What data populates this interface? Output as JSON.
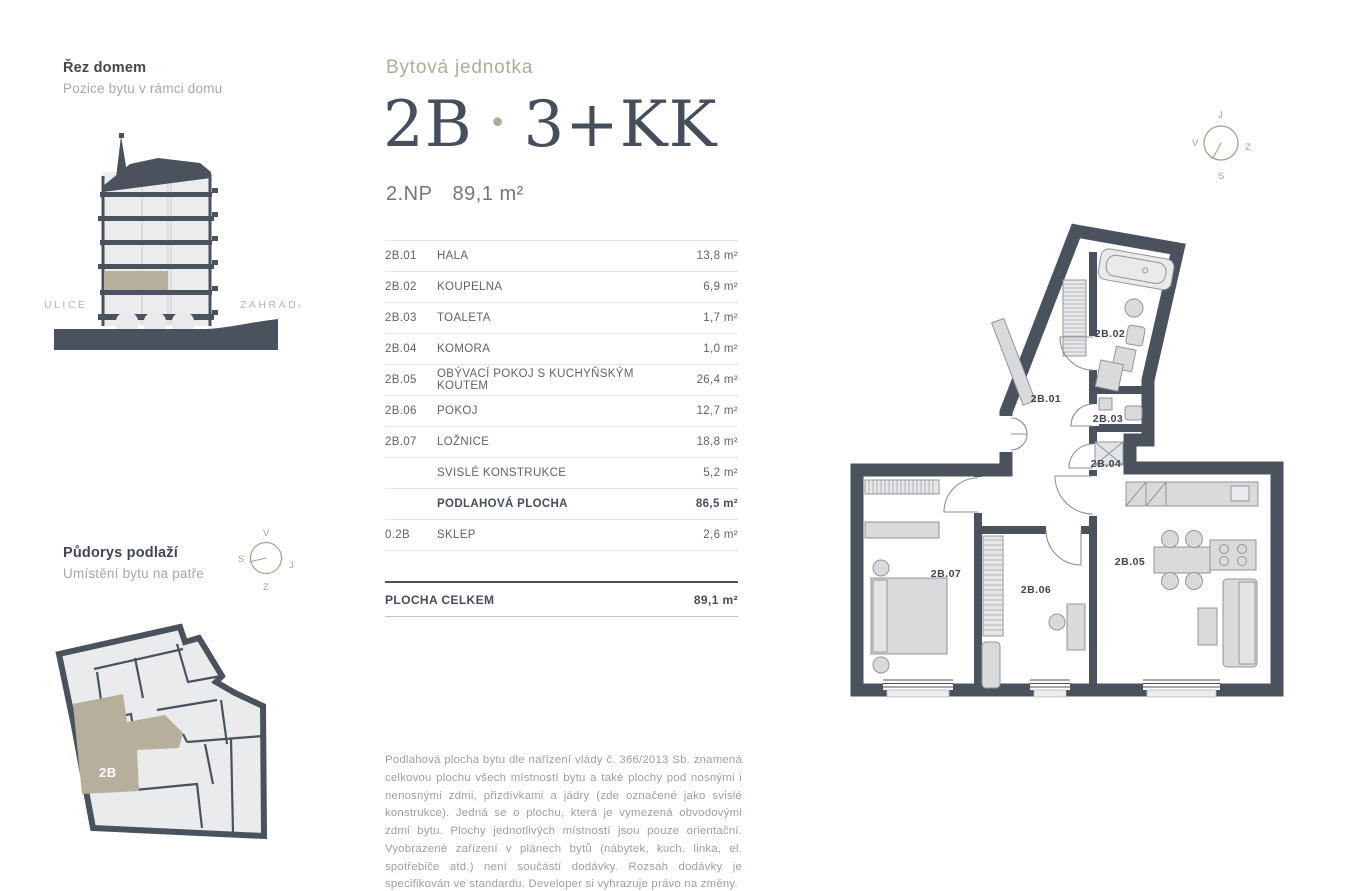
{
  "colors": {
    "wall_dark": "#4a525e",
    "title_dark": "#454e5b",
    "gold": "#b2ab96",
    "beige_highlight": "#b6af9c",
    "room_fill": "#eaebec",
    "furniture_fill": "#d9dadb",
    "muted_text": "#9aa0a7"
  },
  "section_view": {
    "title": "Řez domem",
    "subtitle": "Pozice bytu v rámci domu",
    "label_left": "ULICE",
    "label_right": "ZAHRADA"
  },
  "floor_overview": {
    "title": "Půdorys podlaží",
    "subtitle": "Umístění bytu na patře",
    "unit_label": "2B",
    "compass": {
      "top": "V",
      "left": "S",
      "right": "J",
      "bottom": "Z"
    }
  },
  "header": {
    "eyebrow": "Bytová jednotka",
    "unit": "2B",
    "separator": "•",
    "layout": "3+KK",
    "floor": "2.NP",
    "area": "89,1 m²"
  },
  "table": {
    "rows": [
      {
        "code": "2B.01",
        "name": "HALA",
        "area": "13,8 m²"
      },
      {
        "code": "2B.02",
        "name": "KOUPELNA",
        "area": "6,9 m²"
      },
      {
        "code": "2B.03",
        "name": "TOALETA",
        "area": "1,7 m²"
      },
      {
        "code": "2B.04",
        "name": "KOMORA",
        "area": "1,0 m²"
      },
      {
        "code": "2B.05",
        "name": "OBÝVACÍ POKOJ S KUCHYŇSKÝM KOUTEM",
        "area": "26,4 m²"
      },
      {
        "code": "2B.06",
        "name": "POKOJ",
        "area": "12,7 m²"
      },
      {
        "code": "2B.07",
        "name": "LOŽNICE",
        "area": "18,8 m²"
      },
      {
        "code": "",
        "name": "SVISLÉ KONSTRUKCE",
        "area": "5,2 m²"
      },
      {
        "code": "",
        "name": "PODLAHOVÁ PLOCHA",
        "area": "86,5 m²"
      },
      {
        "code": "0.2B",
        "name": "SKLEP",
        "area": "2,6 m²"
      }
    ],
    "total": {
      "name": "PLOCHA CELKEM",
      "area": "89,1 m²"
    }
  },
  "disclaimer": "Podlahová plocha bytu dle nařízení vlády č. 366/2013 Sb. znamená celkovou plochu všech místností bytu a také plochy pod nosnými i nenosnými zdmi, přizdívkami a jádry (zde označené jako svislé konstrukce). Jedná se o plochu, která je vymezená obvodovými zdmi bytu. Plochy jednotlivých místností jsou pouze orientační. Vyobrazené zařízení v plánech bytů (nábytek, kuch. linka, el. spotřebiče atd.) není součástí dodávky. Rozsah dodávky je specifikován ve standardu. Developer si vyhrazuje právo na změny.",
  "plan": {
    "labels": [
      "2B.01",
      "2B.02",
      "2B.03",
      "2B.04",
      "2B.05",
      "2B.06",
      "2B.07"
    ],
    "compass": {
      "top": "J",
      "left": "V",
      "right": "Z",
      "bottom": "S"
    }
  }
}
